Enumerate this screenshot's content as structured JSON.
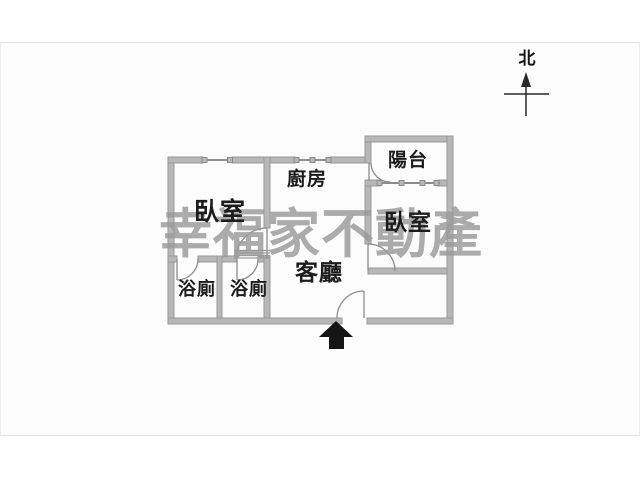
{
  "photo": {
    "watermark_text": "幸福家不動產",
    "compass": {
      "label": "北"
    },
    "rooms": [
      {
        "id": "bedroom-left",
        "label": "臥室"
      },
      {
        "id": "kitchen",
        "label": "廚房"
      },
      {
        "id": "balcony",
        "label": "陽台"
      },
      {
        "id": "bedroom-right",
        "label": "臥室"
      },
      {
        "id": "living-room",
        "label": "客廳"
      },
      {
        "id": "bathroom-1",
        "label": "浴廁"
      },
      {
        "id": "bathroom-2",
        "label": "浴廁"
      }
    ],
    "icons": {
      "entrance_arrow": "up-arrow-entrance",
      "north_arrow": "north-compass-arrow"
    },
    "colors": {
      "wall": "#b7b7b7",
      "wall_edge": "#989898",
      "thin_line": "#8c8c8c",
      "label_text": "#1c1c1c",
      "watermark": "#9a9a9a",
      "photo_background": "#fcfcfc",
      "page_background": "#ffffff",
      "frame_border": "#e0e0e0",
      "arrow_black": "#151515"
    }
  }
}
